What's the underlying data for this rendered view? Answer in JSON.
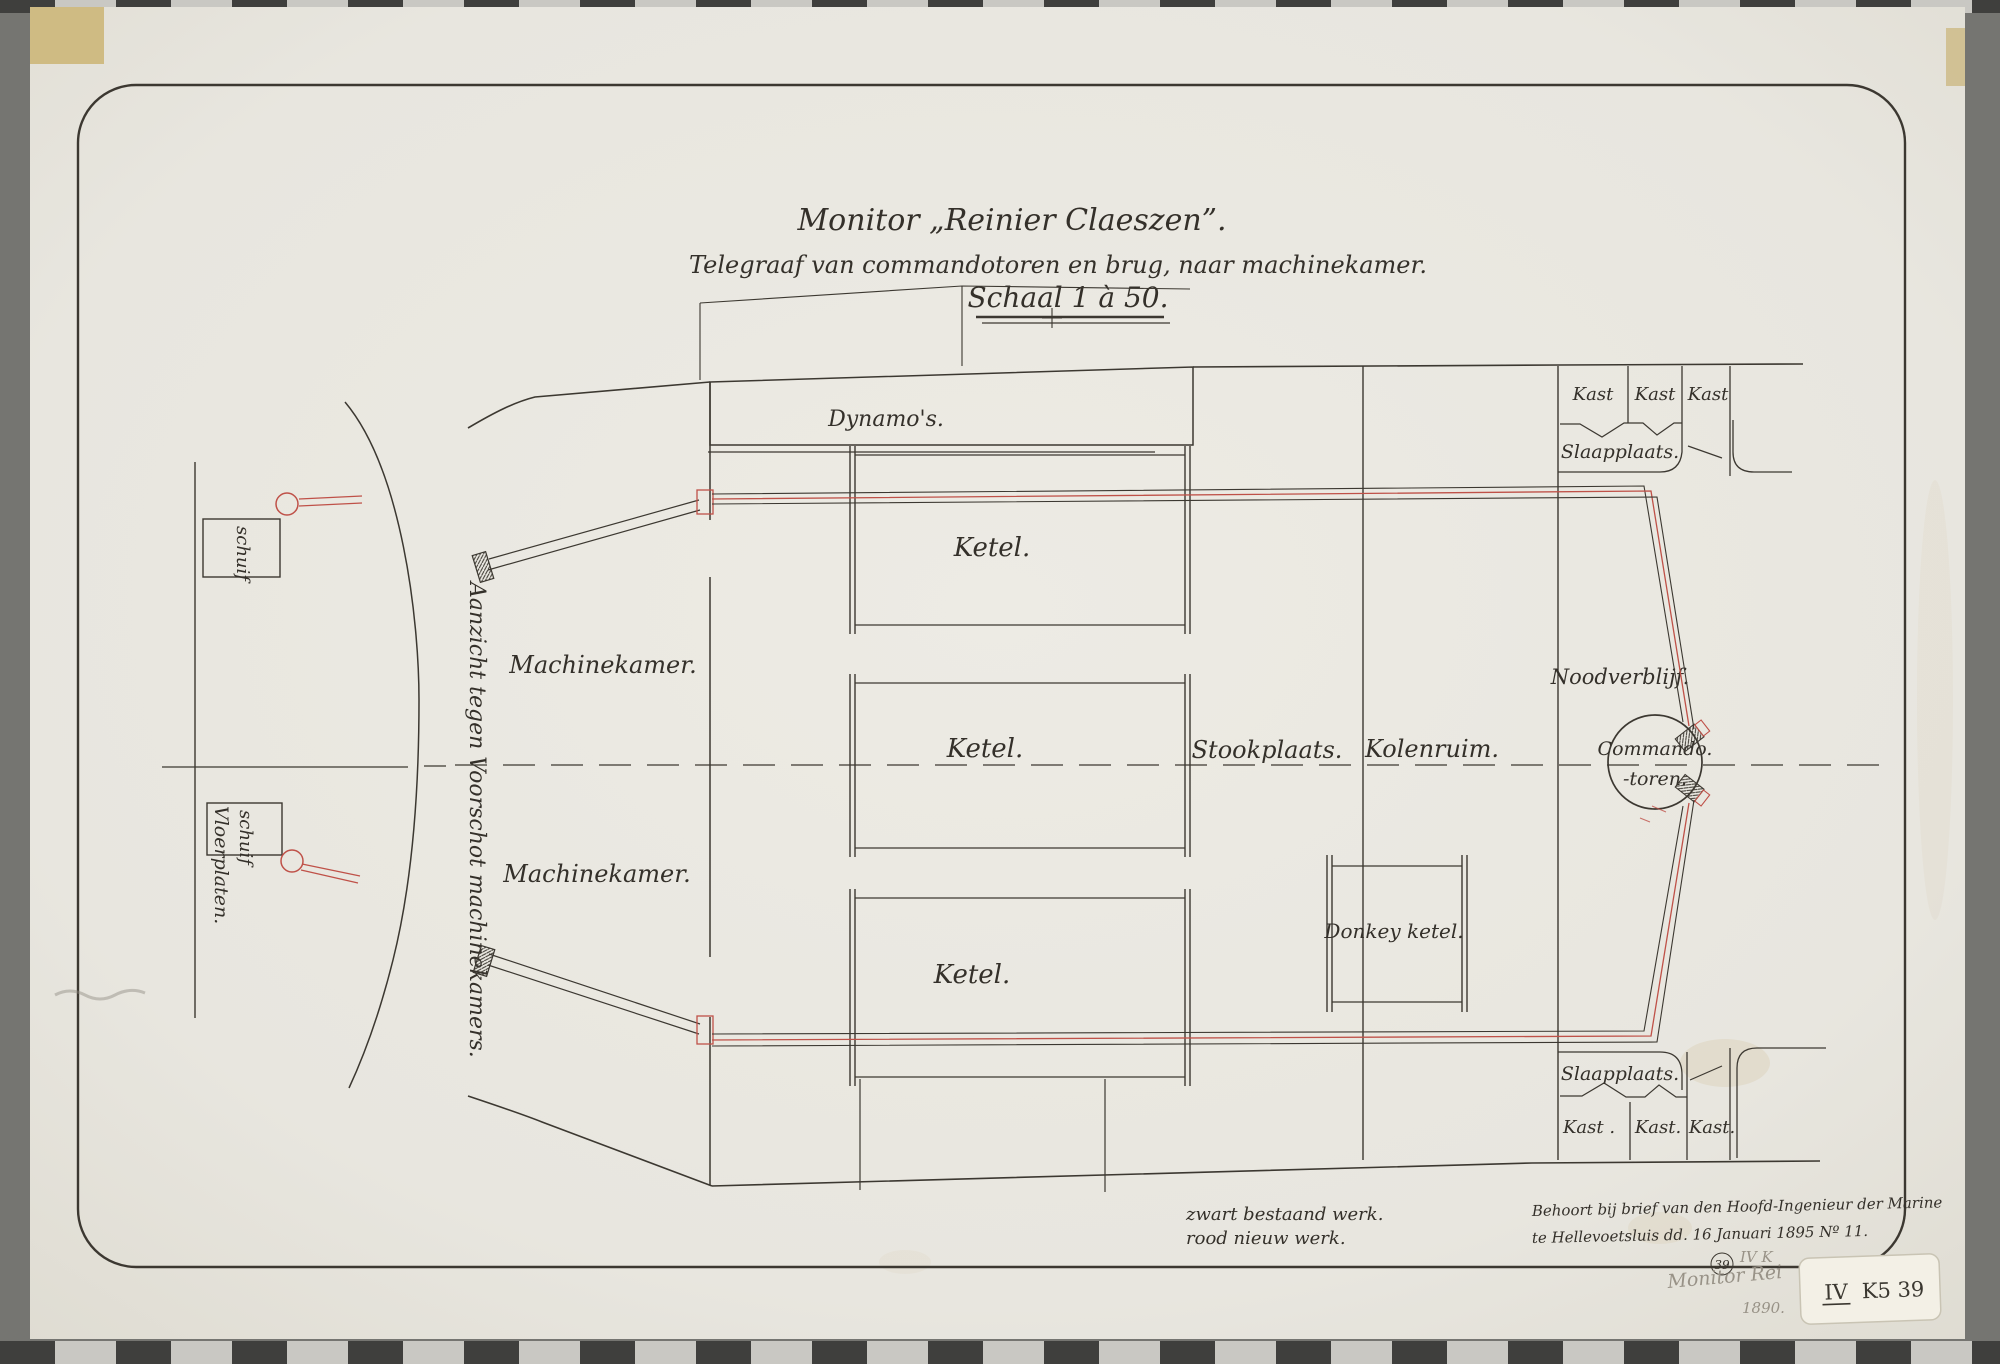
{
  "document": {
    "title": "Monitor „Reinier Claeszen”.",
    "subtitle": "Telegraaf van commandotoren en brug, naar machinekamer.",
    "scale_label": "Schaal 1 à 50.",
    "legend": {
      "black_line": "zwart bestaand werk.",
      "red_line": "rood nieuw werk."
    },
    "note_line1": "Behoort bij brief van den Hoofd-Ingenieur der Marine",
    "note_line2": "te Hellevoetsluis dd. 16 Januari 1895 Nº 11.",
    "stamp_number": "39",
    "pencil_class": "IV K",
    "pencil_title": "Monitor Rei",
    "pencil_year": "1890.",
    "sticker": {
      "numeral": "IV",
      "code": "K5 39"
    }
  },
  "labels": {
    "dynamos": "Dynamo's.",
    "ketel": "Ketel.",
    "machinekamer": "Machinekamer.",
    "stookplaats": "Stookplaats.",
    "kolenruim": "Kolenruim.",
    "donkey_ketel": "Donkey ketel.",
    "noodverblijf": "Noodverblijf.",
    "commando_line1": "Commando.",
    "commando_line2": "-toren.",
    "slaapplaats": "Slaapplaats.",
    "kast_top": [
      "Kast",
      "Kast",
      "Kast"
    ],
    "kast_bottom": [
      "Kast .",
      "Kast.",
      "Kast."
    ],
    "schuif": "schuif",
    "vloerplaten": "Vloerplaten.",
    "end_view_caption": "Aanzicht tegen Voorschot machinekamers."
  },
  "colors": {
    "ink": "#3c3831",
    "new_work_red": "#bf5148",
    "paper": "#e8e6df",
    "scanner_background": "#757571",
    "sticker": "#f3f0e6"
  }
}
